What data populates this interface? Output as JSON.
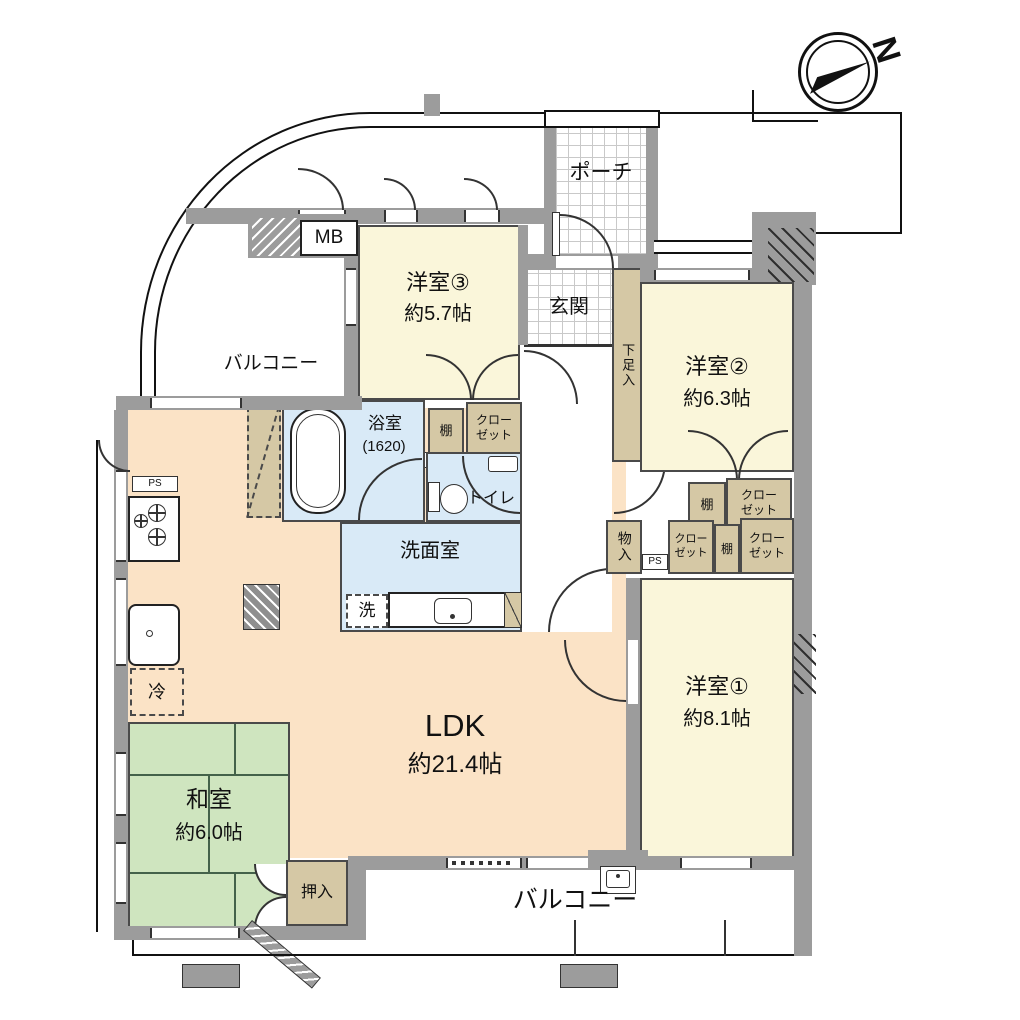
{
  "compass": {
    "north": "N"
  },
  "rooms": {
    "porch": "ポーチ",
    "entrance": "玄関",
    "western_room_3": {
      "name": "洋室③",
      "size": "約5.7帖"
    },
    "western_room_2": {
      "name": "洋室②",
      "size": "約6.3帖"
    },
    "western_room_1": {
      "name": "洋室①",
      "size": "約8.1帖"
    },
    "ldk": {
      "name": "LDK",
      "size": "約21.4帖"
    },
    "japanese_room": {
      "name": "和室",
      "size": "約6.0帖"
    },
    "bath": {
      "name": "浴室",
      "size": "(1620)"
    },
    "washroom": "洗面室",
    "toilet": "トイレ",
    "balcony_north": "バルコニー",
    "balcony_south": "バルコニー"
  },
  "storage": {
    "shoe_storage": "下足入",
    "oshiire": "押入",
    "monoire": "物入",
    "shelf": "棚",
    "closet_line1": "クロー",
    "closet_line2": "ゼット"
  },
  "fixtures": {
    "meter_box": "MB",
    "pipe_space": "PS",
    "washer": "洗",
    "fridge": "冷"
  },
  "colors": {
    "room_yellow": "#faf6da",
    "ldk_peach": "#fbe3c6",
    "tatami_green": "#cfe5bf",
    "water_blue": "#d9eaf7",
    "storage_tan": "#d5c8a5",
    "wall_gray": "#9c9c9c"
  }
}
